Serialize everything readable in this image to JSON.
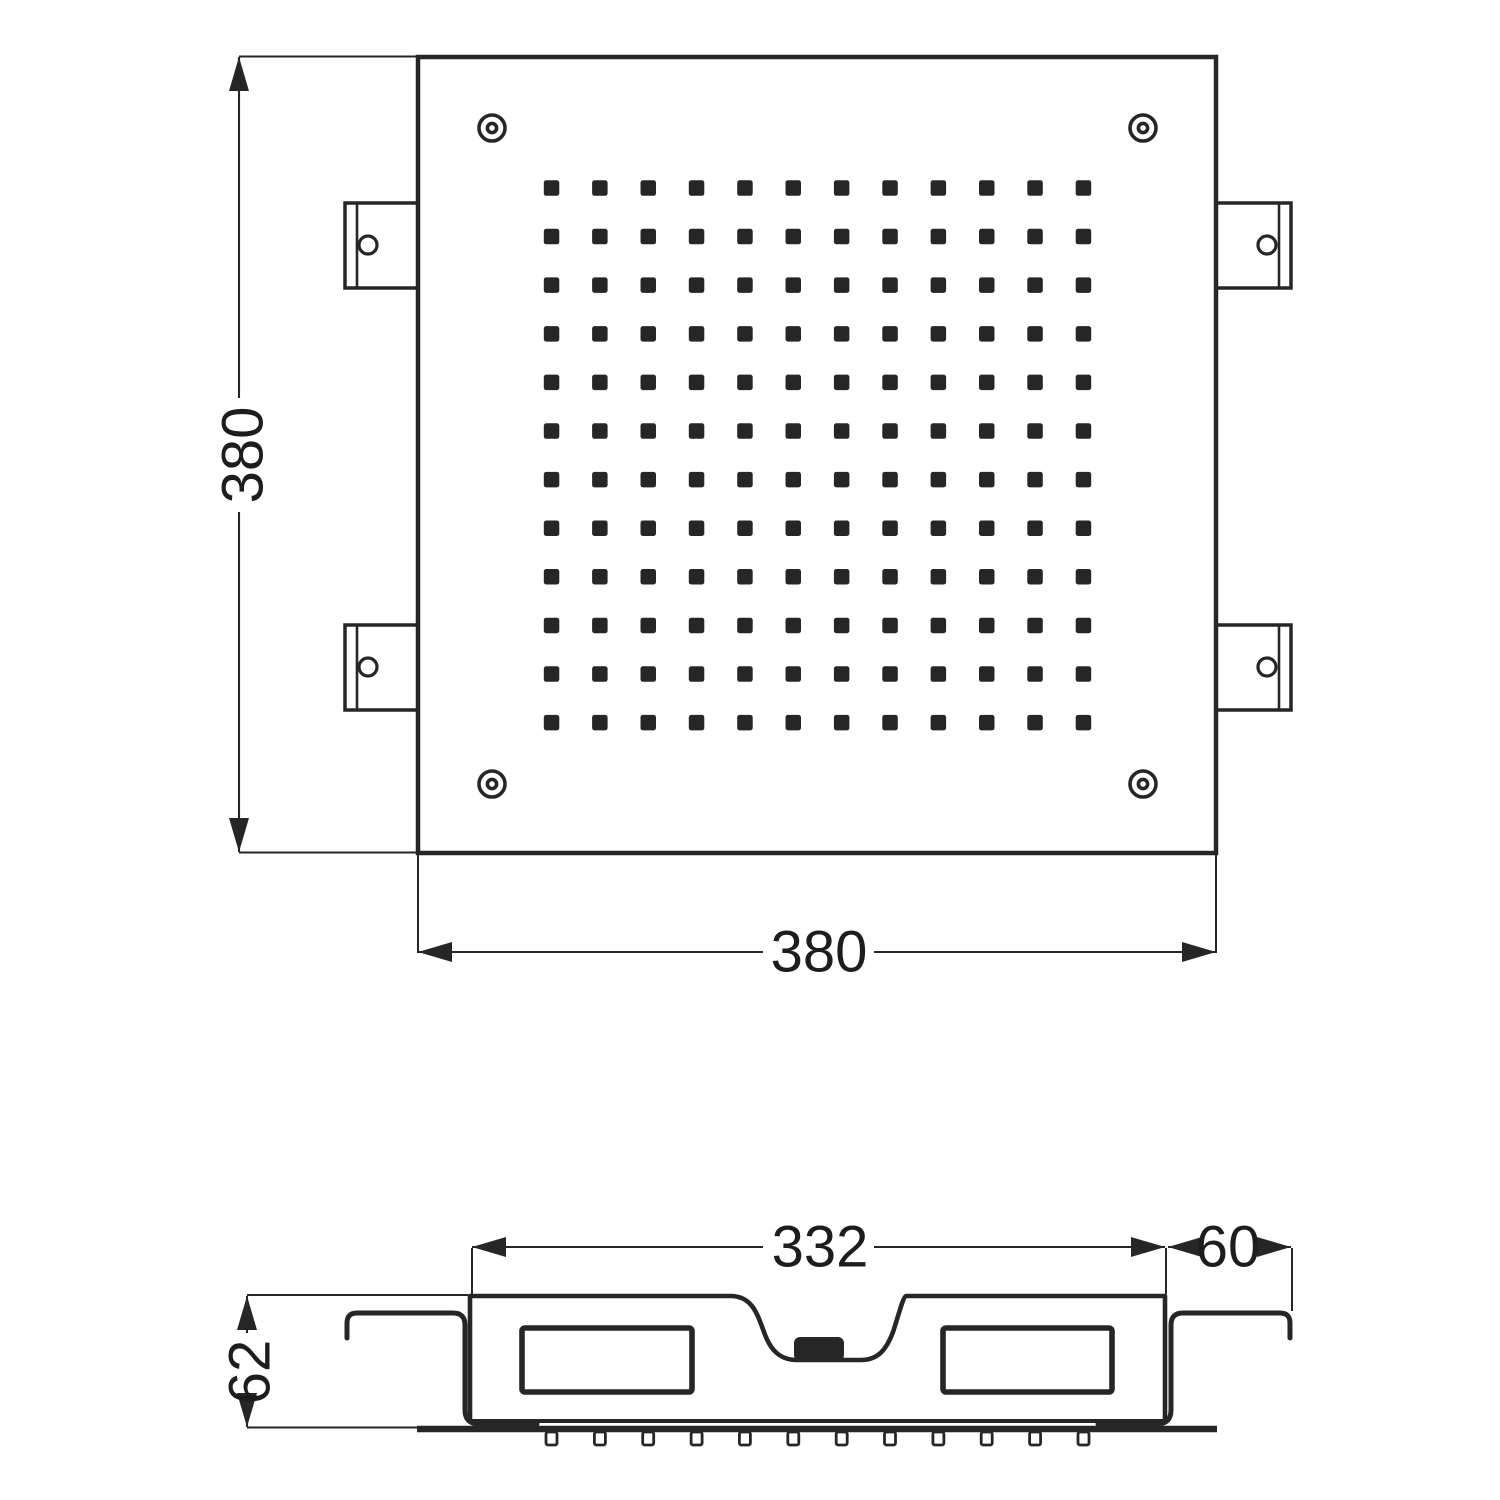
{
  "top_view": {
    "height_dim": "380",
    "width_dim": "380",
    "nozzle_grid": {
      "rows": 12,
      "cols": 12
    },
    "corner_screw_count": 4,
    "mounting_tab_count": 4
  },
  "side_view": {
    "body_width_dim": "332",
    "tab_overhang_dim": "60",
    "height_dim": "62",
    "nozzle_count": 12
  },
  "colors": {
    "line": "#262626",
    "background": "#ffffff"
  }
}
